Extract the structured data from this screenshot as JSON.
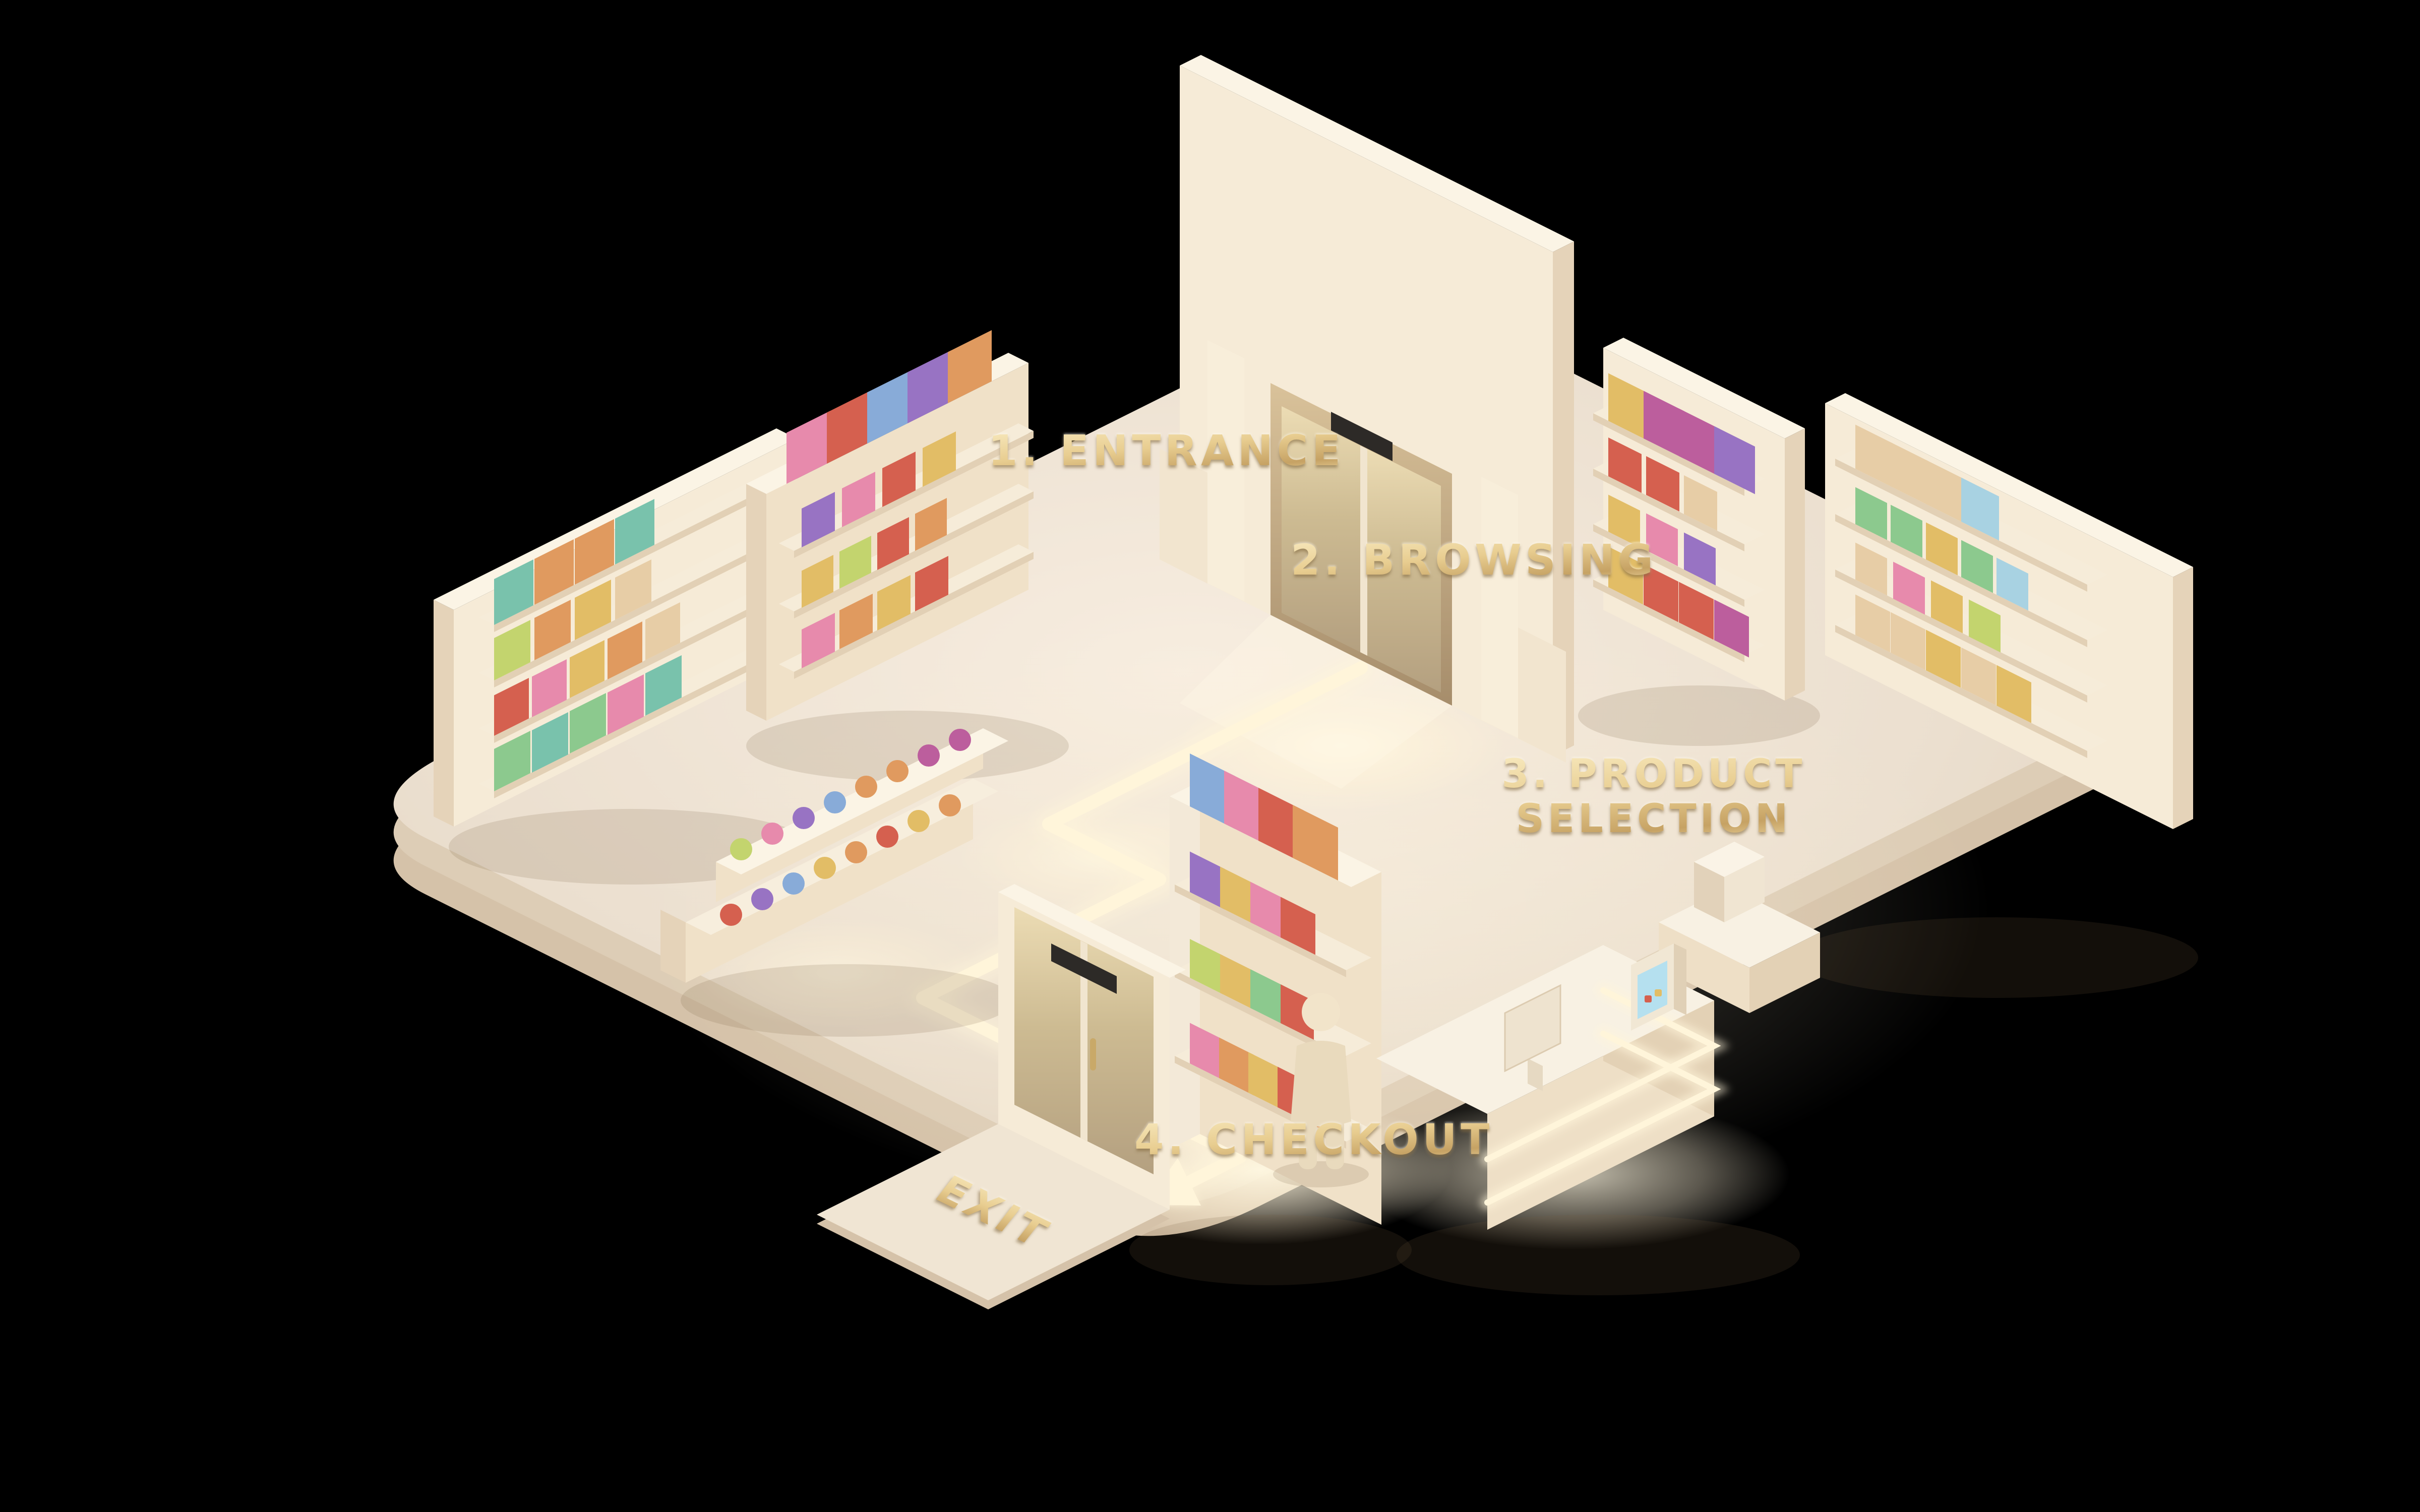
{
  "scene": {
    "description": "Isometric 3D miniature retail store showing the customer journey flow",
    "journey_steps": [
      {
        "label": "1. ENTRANCE"
      },
      {
        "label": "2. BROWSING"
      },
      {
        "label": "3. PRODUCT SELECTION",
        "line1": "3. PRODUCT",
        "line2": "SELECTION"
      },
      {
        "label": "4. CHECKOUT"
      }
    ],
    "exit_label": "EXIT"
  },
  "colors": {
    "background": "#000000",
    "floor_top": "#f7ede0",
    "floor_mid": "#ebdfcf",
    "floor_deep": "#ddcdb6",
    "floor_side": "#d5c2a9",
    "wall_front": "#f6ebd7",
    "wall_side": "#e5d3b9",
    "wall_top": "#fbf4e5",
    "shelf_wood": "#f0e1c8",
    "board": "#f6ecd9",
    "board_edge": "#e2d0b5",
    "counter_top": "#f8f1e3",
    "counter_base": "#eedfc6",
    "counter_side": "#e3d1b5",
    "mat": "#f0e5d3",
    "sensor": "#2d2a27",
    "glow": "#fff5da",
    "gold": "#e2c387",
    "person_body": "#e9dabd",
    "person_head": "#f2e4ca",
    "screen_blue": "#b5e0ef",
    "glass_top": "#ecdcb4",
    "glass_bottom": "#b4a080",
    "doorway_top": "#d9c29a",
    "doorway_bottom": "#a68d6b",
    "palette": [
      "#79c2ac",
      "#8cc98e",
      "#c3d46e",
      "#e2bd66",
      "#e09a5f",
      "#d5604f",
      "#e78aac",
      "#bc5e9d",
      "#9873c3",
      "#88abd8",
      "#e7cda6",
      "#a8d2e2"
    ]
  }
}
